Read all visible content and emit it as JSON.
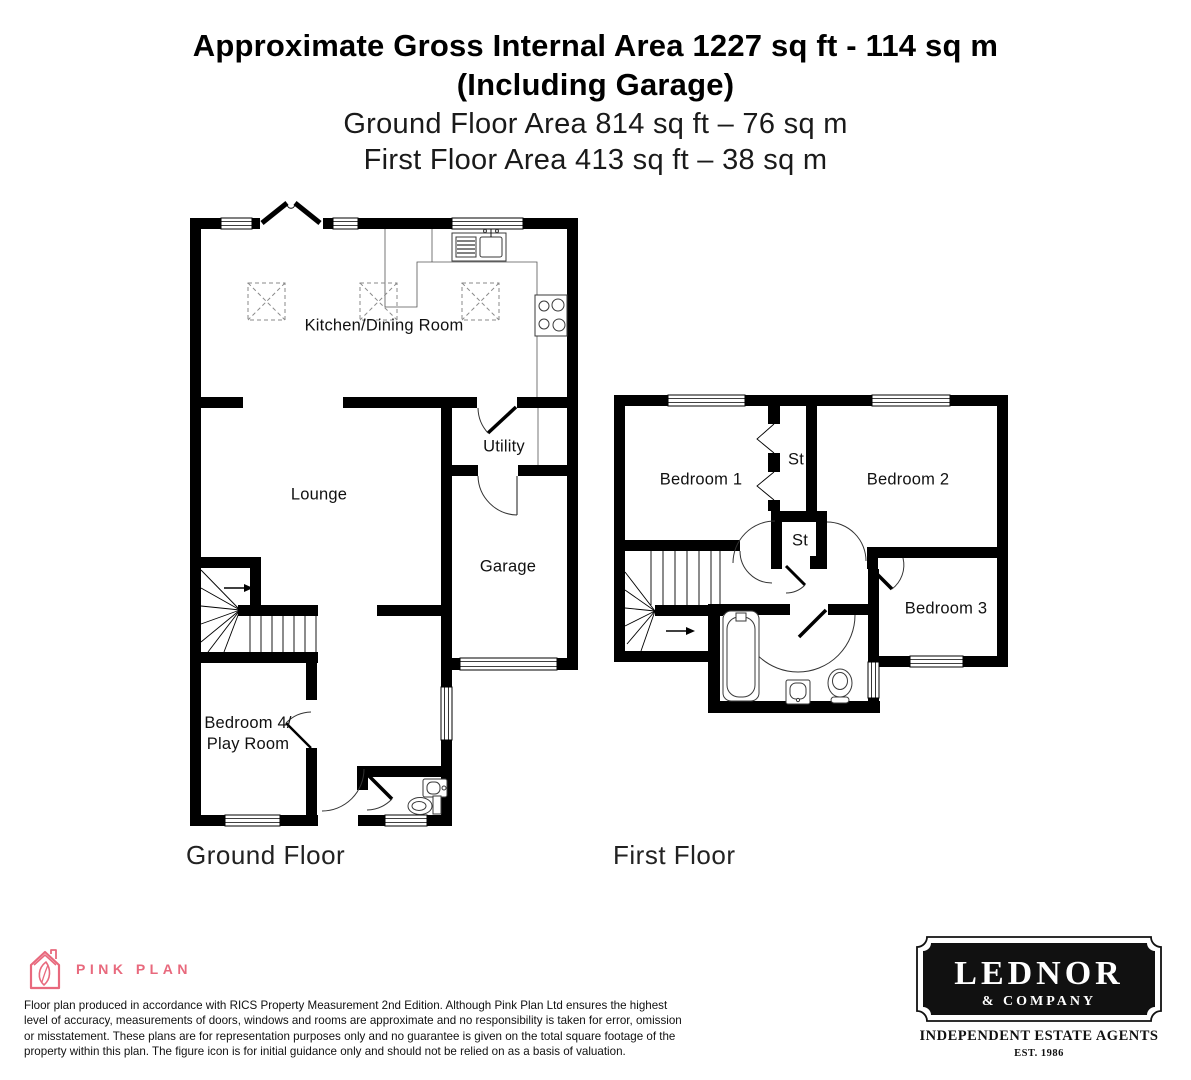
{
  "header": {
    "title_line1": "Approximate Gross Internal Area 1227 sq ft - 114 sq m",
    "title_line2": "(Including Garage)",
    "subtitle_line1": "Ground Floor Area 814 sq ft – 76 sq m",
    "subtitle_line2": "First Floor Area 413 sq ft – 38 sq m"
  },
  "plans": {
    "ground_floor": {
      "label": "Ground Floor",
      "rooms": {
        "kitchen_dining": "Kitchen/Dining Room",
        "utility": "Utility",
        "lounge": "Lounge",
        "garage": "Garage",
        "bedroom4_line1": "Bedroom 4/",
        "bedroom4_line2": "Play Room"
      }
    },
    "first_floor": {
      "label": "First Floor",
      "rooms": {
        "bedroom1": "Bedroom 1",
        "bedroom2": "Bedroom 2",
        "bedroom3": "Bedroom 3",
        "storage_top": "St",
        "storage_middle": "St"
      }
    }
  },
  "footer": {
    "pink_plan": {
      "brand": "PINK PLAN",
      "brand_color": "#e8697d",
      "disclaimer": "Floor plan produced in accordance with RICS Property Measurement 2nd Edition. Although Pink Plan Ltd ensures the highest level of accuracy, measurements of doors, windows and rooms are approximate and no responsibility is taken for error, omission or misstatement. These plans are for representation purposes only and no guarantee is given on the total square footage of the property within this plan. The figure icon is for initial guidance only and should not be relied on as a basis of valuation."
    },
    "agent": {
      "name": "LEDNOR",
      "company": "& COMPANY",
      "tagline": "INDEPENDENT ESTATE AGENTS",
      "established": "EST. 1986"
    }
  },
  "colors": {
    "wall": "#000000",
    "background": "#ffffff"
  }
}
